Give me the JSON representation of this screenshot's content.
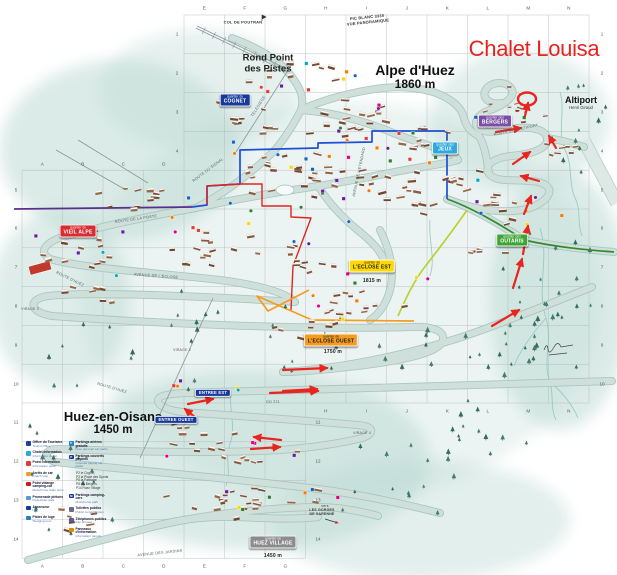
{
  "title": {
    "text": "Chalet Louisa",
    "x": 534,
    "y": 49,
    "color": "#e8231f"
  },
  "places": {
    "alpe": {
      "name": "Alpe d'Huez",
      "elev": "1860 m",
      "x": 415,
      "y": 77
    },
    "rond": {
      "line1": "Rond Point",
      "line2": "des Pistes",
      "x": 268,
      "y": 64
    },
    "huez": {
      "name": "Huez-en-Oisans",
      "elev": "1450 m",
      "x": 113,
      "y": 423
    },
    "altiport": {
      "name": "Altiport",
      "sub": "Henri Giraud",
      "x": 581,
      "y": 103
    }
  },
  "badges": [
    {
      "q": "quartier du",
      "name": "COGNET",
      "x": 235,
      "y": 100,
      "bg": "#16399a",
      "fg": "#fff"
    },
    {
      "q": "quartier des",
      "name": "JEUX",
      "x": 445,
      "y": 148,
      "bg": "#2fa9dd",
      "fg": "#fff"
    },
    {
      "q": "quartier des",
      "name": "BERGERS",
      "x": 495,
      "y": 121,
      "bg": "#7c4ea3",
      "fg": "#fff"
    },
    {
      "q": "quartier des",
      "name": "OUTARIS",
      "x": 512,
      "y": 240,
      "bg": "#3fa437",
      "fg": "#fff"
    },
    {
      "q": "quartier du",
      "name": "VIEIL ALPE",
      "x": 78,
      "y": 231,
      "bg": "#d92b32",
      "fg": "#fff"
    },
    {
      "q": "quartier de",
      "name": "L'ECLOSE EST",
      "x": 372,
      "y": 266,
      "bg": "#ffd800",
      "fg": "#222"
    },
    {
      "q": "quartier de",
      "name": "L'ECLOSE OUEST",
      "x": 331,
      "y": 340,
      "bg": "#f59b20",
      "fg": "#222"
    },
    {
      "q": "quartier de",
      "name": "HUEZ VILLAGE",
      "x": 273,
      "y": 542,
      "bg": "#8c8c8c",
      "fg": "#fff"
    },
    {
      "name": "ENTREE EST",
      "x": 213,
      "y": 393,
      "bg": "#16399a",
      "fg": "#fff"
    },
    {
      "name": "ENTREE OUEST",
      "x": 176,
      "y": 420,
      "bg": "#16399a",
      "fg": "#fff"
    }
  ],
  "small_labels": [
    {
      "t": "COL DE POUTRAN",
      "x": 243,
      "y": 22,
      "s": 4,
      "rot": 0,
      "c": "#333",
      "b": 1
    },
    {
      "t": "PIC BLANC 3330",
      "x": 367,
      "y": 17,
      "s": 4,
      "rot": -6,
      "c": "#333",
      "b": 1
    },
    {
      "t": "VUE PANORAMIQUE",
      "x": 368,
      "y": 22,
      "s": 4,
      "rot": -6,
      "c": "#333",
      "b": 1
    },
    {
      "t": "TELESIEGE",
      "x": 258,
      "y": 106,
      "s": 4,
      "rot": -58,
      "c": "#667",
      "b": 0
    },
    {
      "t": "ROUTE DU SIGNAL",
      "x": 208,
      "y": 170,
      "s": 3.8,
      "rot": -37,
      "c": "#4d6a66",
      "b": 0
    },
    {
      "t": "ROUTE DE LA POSTE",
      "x": 136,
      "y": 219,
      "s": 3.8,
      "rot": -8,
      "c": "#4d6a66",
      "b": 0
    },
    {
      "t": "AVENUE DE L'ETENDARD",
      "x": 359,
      "y": 172,
      "s": 3.8,
      "rot": -78,
      "c": "#4d6a66",
      "b": 0
    },
    {
      "t": "AVENUE DE L'ECLOSE",
      "x": 156,
      "y": 276,
      "s": 3.8,
      "rot": 4,
      "c": "#4d6a66",
      "b": 0
    },
    {
      "t": "ROUTE D'HUEZ",
      "x": 70,
      "y": 279,
      "s": 3.8,
      "rot": 26,
      "c": "#4d6a66",
      "b": 0
    },
    {
      "t": "ROUTE D'HUEZ",
      "x": 112,
      "y": 388,
      "s": 3.8,
      "rot": 16,
      "c": "#4d6a66",
      "b": 0
    },
    {
      "t": "ROUTE DE L'ALTIPORT",
      "x": 516,
      "y": 130,
      "s": 3.8,
      "rot": -12,
      "c": "#4d6a66",
      "b": 0
    },
    {
      "t": "AVENUE DES JARDINS",
      "x": 160,
      "y": 553,
      "s": 3.8,
      "rot": -6,
      "c": "#4d6a66",
      "b": 0
    },
    {
      "t": "RD 211",
      "x": 273,
      "y": 402,
      "s": 3.8,
      "rot": -2,
      "c": "#4d6a66",
      "b": 0
    },
    {
      "t": "VIRAGE 2",
      "x": 182,
      "y": 350,
      "s": 3.5,
      "rot": 0,
      "c": "#555",
      "b": 0
    },
    {
      "t": "VIRAGE 3",
      "x": 30,
      "y": 309,
      "s": 3.5,
      "rot": 0,
      "c": "#555",
      "b": 0
    },
    {
      "t": "VIRAGE 4",
      "x": 362,
      "y": 433,
      "s": 3.5,
      "rot": 0,
      "c": "#555",
      "b": 0
    },
    {
      "t": "vers",
      "x": 325,
      "y": 506,
      "s": 3.5,
      "rot": 0,
      "c": "#333",
      "b": 0
    },
    {
      "t": "LES GORGES",
      "x": 322,
      "y": 510,
      "s": 3.5,
      "rot": 0,
      "c": "#333",
      "b": 1
    },
    {
      "t": "DE SARENNE",
      "x": 322,
      "y": 514,
      "s": 3.5,
      "rot": 0,
      "c": "#333",
      "b": 1
    },
    {
      "t": "1815 m",
      "x": 372,
      "y": 281,
      "s": 5,
      "rot": 0,
      "c": "#222",
      "b": 1
    },
    {
      "t": "1750 m",
      "x": 333,
      "y": 352,
      "s": 5,
      "rot": 0,
      "c": "#222",
      "b": 1
    },
    {
      "t": "1450 m",
      "x": 273,
      "y": 556,
      "s": 5,
      "rot": 0,
      "c": "#222",
      "b": 1
    }
  ],
  "grid": {
    "dx": 40.5,
    "dy": 38.8,
    "top": [
      "E",
      "F",
      "G",
      "H",
      "I",
      "J",
      "K",
      "L",
      "M",
      "N"
    ],
    "top_y": 8,
    "top_x0": 204.3,
    "mid": [
      "A",
      "B",
      "C",
      "D"
    ],
    "mid_y": 164,
    "mid_x0": 42.3,
    "bottom": [
      "A",
      "B",
      "C",
      "D",
      "E",
      "F",
      "G"
    ],
    "bottom_y": 566,
    "bottom_x0": 42.3,
    "bottom_right": [
      "H",
      "I",
      "J",
      "K",
      "L",
      "M",
      "N"
    ],
    "br_y": 411,
    "br_x0": 325.8,
    "left_upper": [
      "1",
      "2",
      "3",
      "4"
    ],
    "lu_x": 177,
    "lu_y0": 34.4,
    "left_lower": [
      "5",
      "6",
      "7",
      "8",
      "9",
      "10",
      "11",
      "12",
      "13",
      "14"
    ],
    "ll_x": 16,
    "ll_y0": 189.6,
    "right_upper": [
      "1",
      "2",
      "3",
      "4",
      "5",
      "6",
      "7",
      "8",
      "9",
      "10"
    ],
    "ru_x": 602,
    "ru_y0": 34.4,
    "right_lower": [
      "11",
      "12",
      "13",
      "14"
    ],
    "rl_x": 318,
    "rl_y0": 422.4
  },
  "legend": {
    "x": 26,
    "y": 441,
    "left": [
      {
        "c": "#1e3f9e",
        "t": "Office du Tourisme",
        "s": "Tourist Office"
      },
      {
        "c": "#2fa9dd",
        "t": "Chalet information",
        "s": "Information chalet"
      },
      {
        "c": "#e03a3a",
        "t": "Point information",
        "s": "Information point"
      },
      {
        "c": "#f0a020",
        "t": "Arrêts de car",
        "s": "Coach stop"
      },
      {
        "c": "#d01818",
        "t": "Point vidange camping-car",
        "s": "Motorhome drain point"
      },
      {
        "c": "#5599dd",
        "t": "Promenade piétons",
        "s": "Pedestrian walk"
      },
      {
        "c": "#16399a",
        "t": "Ascenseur",
        "s": "Lift"
      },
      {
        "c": "#2a7fc0",
        "t": "Pistes de luge",
        "s": "Sledging runs"
      }
    ],
    "right": [
      {
        "c": "#2a7fc0",
        "p": "P",
        "t": "Parkings aériens gratuits",
        "s": "Free open-air car parks"
      },
      {
        "c": "#16399a",
        "p": "P",
        "t": "Parkings couverts payants",
        "s": "Covered paying car parks"
      },
      {
        "list": [
          "P2 le Cognet",
          "P3 la Place des Sports",
          "P5 la Patinoire",
          "P8 les Bergers",
          "P14 Huez Village"
        ]
      },
      {
        "c": "#16399a",
        "p": "M",
        "t": "Parkings camping-cars",
        "s": "Motorhome park"
      },
      {
        "c": "#6a6a8a",
        "t": "Toilettes publics",
        "s": "Public conveniences"
      },
      {
        "c": "#5a5a9a",
        "t": "Téléphones publics",
        "s": "Pay phones"
      },
      {
        "c": "#e08a00",
        "t": "Panneaux d'information",
        "s": "Information panels"
      }
    ]
  },
  "colors": {
    "wash": "#b9d8d1",
    "road_fill": "#cfe0da",
    "road_edge": "#a5c2bb",
    "grid": "#a9aeae",
    "red": "#e8251f",
    "stream": "#8fc6c0",
    "building_palette": [
      "#8a5a40",
      "#7a4c34",
      "#95684a",
      "#6e452f"
    ],
    "tree_palette": [
      "#2f6e5f",
      "#417e6d"
    ],
    "marker_palette": [
      "#e6007e",
      "#1565c0",
      "#ffd500",
      "#6a1b9a",
      "#00a7cf",
      "#e53935",
      "#f57c00",
      "#2e7d32"
    ]
  },
  "washes": [
    {
      "x": 120,
      "y": 150,
      "rx": 120,
      "ry": 90,
      "o": 0.5
    },
    {
      "x": 60,
      "y": 300,
      "rx": 70,
      "ry": 90,
      "o": 0.45
    },
    {
      "x": 340,
      "y": 300,
      "rx": 260,
      "ry": 200,
      "o": 0.28
    },
    {
      "x": 250,
      "y": 460,
      "rx": 180,
      "ry": 90,
      "o": 0.5
    },
    {
      "x": 560,
      "y": 300,
      "rx": 70,
      "ry": 130,
      "o": 0.5
    },
    {
      "x": 520,
      "y": 120,
      "rx": 90,
      "ry": 70,
      "o": 0.4
    },
    {
      "x": 200,
      "y": 90,
      "rx": 100,
      "ry": 60,
      "o": 0.35
    },
    {
      "x": 420,
      "y": 520,
      "rx": 150,
      "ry": 60,
      "o": 0.4
    }
  ],
  "roads": [
    "M 28,560 C 70,548 115,537 152,527 C 200,515 260,508 318,507 C 340,507 360,511 378,516",
    "M 152,527 C 175,520 205,516 235,517 C 265,518 292,520 318,517",
    "M 55,462 C 130,470 230,478 318,489 C 358,494 400,503 440,513",
    "M 55,462 C 43,458 43,449 58,449 C 125,451 205,454 280,450 C 320,447 346,442 362,438",
    "M 362,438 C 375,434 375,426 357,425 C 300,420 240,416 182,412",
    "M 612,381 C 500,385 350,389 212,392 C 186,393 164,393 159,398 C 155,404 165,410 182,412",
    "M 283,372 C 350,368 430,350 490,327 C 530,312 562,299 592,287",
    "M 295,302 C 220,297 90,291 48,296 C 28,299 28,312 52,316 C 150,323 300,330 413,327 C 438,326 449,334 440,345 C 428,357 380,364 330,369 C 308,371 292,372 283,372",
    "M 62,237 C 45,243 38,252 50,259 C 80,268 150,272 220,280 C 258,285 285,292 295,302",
    "M 62,237 C 120,222 160,214 196,208 C 240,198 280,192 318,186 C 352,181 392,172 422,167 C 442,164 452,162 458,160",
    "M 196,208 C 230,190 255,170 275,150 C 285,138 295,122 301,110",
    "M 301,110 C 306,95 296,82 288,72 C 276,58 252,45 232,38",
    "M 301,110 C 330,112 360,120 386,130 C 410,140 430,146 447,151 C 452,153 456,156 458,160",
    "M 301,110 C 322,100 352,92 382,88 C 402,86 422,88 436,93 C 452,99 462,108 464,118 C 466,127 472,133 479,136",
    "M 447,199 C 480,212 510,214 530,208 C 552,200 556,186 538,182 C 518,178 498,184 489,174 C 483,166 493,158 511,156 C 533,154 549,148 547,138 C 545,128 527,126 511,129 C 495,132 483,134 477,127 C 473,120 481,112 493,109",
    "M 479,136 C 485,146 487,160 489,174",
    "M 493,109 C 505,104 517,96 511,88 C 505,80 489,82 485,91 C 482,99 491,105 501,103",
    "M 547,138 C 560,140 572,143 584,147",
    "M 524,240 C 560,247 590,250 614,252",
    "M 447,199 C 470,207 500,224 524,240",
    "M 380,230 C 390,250 395,270 390,290 C 386,305 378,315 370,320",
    "M 318,186 C 330,205 345,220 360,232 C 372,242 380,250 384,260"
  ],
  "runway": {
    "d": "M 584,141 L 617,203",
    "w": 12
  },
  "streams": [
    "M 560,92 C 566,112 556,132 566,152 C 573,168 568,184 576,200 C 581,212 577,224 582,236",
    "M 540,228 C 550,258 536,288 546,318 C 553,343 542,360 550,382 C 554,396 550,408 556,420",
    "M 546,318 C 532,334 520,350 514,366",
    "M 550,382 C 562,392 572,404 578,418",
    "M 232,388 C 227,408 237,424 230,444 C 224,462 232,470 226,486",
    "M 430,220 C 428,240 436,258 430,276"
  ],
  "routes": [
    {
      "d": "M 14,209 L 192,207",
      "c": "#5b2d8e",
      "w": 1.8
    },
    {
      "d": "M 192,207 L 207,205 L 207,186 L 240,184 L 240,150 L 318,148 L 318,143 L 372,142 L 372,131 L 447,131 L 447,199",
      "c": "#1d4ed8",
      "w": 1.7
    },
    {
      "d": "M 207,204 L 207,186 L 240,184 L 262,184 L 262,206 L 291,206 L 291,217 L 311,218 L 293,266 L 291,310",
      "c": "#e0251f",
      "w": 1.4
    },
    {
      "d": "M 447,199 C 470,207 500,224 524,240 C 560,248 590,250 614,252",
      "c": "#2e8b2e",
      "w": 1.7
    },
    {
      "d": "M 467,210 C 452,232 438,250 424,268 C 414,281 406,298 398,316",
      "c": "#b8d22e",
      "w": 1.7
    },
    {
      "d": "M 414,321 L 312,320 L 257,296 L 268,311 L 309,290",
      "c": "#f59b20",
      "w": 1.7
    }
  ],
  "lifts": [
    {
      "x1": 197,
      "y1": 26,
      "x2": 289,
      "y2": 70,
      "ladder": true
    },
    {
      "x1": 292,
      "y1": 64,
      "x2": 236,
      "y2": 152
    },
    {
      "x1": 213,
      "y1": 298,
      "x2": 140,
      "y2": 458
    },
    {
      "x1": 56,
      "y1": 150,
      "x2": 126,
      "y2": 190
    },
    {
      "x1": 78,
      "y1": 140,
      "x2": 148,
      "y2": 183
    }
  ],
  "building_clusters": [
    {
      "x": 300,
      "y": 72,
      "w": 110,
      "h": 28,
      "n": 9
    },
    {
      "x": 252,
      "y": 118,
      "w": 80,
      "h": 40,
      "n": 10
    },
    {
      "x": 350,
      "y": 118,
      "w": 120,
      "h": 45,
      "n": 18
    },
    {
      "x": 425,
      "y": 140,
      "w": 80,
      "h": 45,
      "n": 12
    },
    {
      "x": 295,
      "y": 170,
      "w": 150,
      "h": 55,
      "n": 24
    },
    {
      "x": 390,
      "y": 195,
      "w": 120,
      "h": 55,
      "n": 18
    },
    {
      "x": 150,
      "y": 192,
      "w": 140,
      "h": 40,
      "n": 12
    },
    {
      "x": 88,
      "y": 245,
      "w": 130,
      "h": 55,
      "n": 12
    },
    {
      "x": 205,
      "y": 250,
      "w": 120,
      "h": 55,
      "n": 14
    },
    {
      "x": 300,
      "y": 258,
      "w": 90,
      "h": 45,
      "n": 10
    },
    {
      "x": 352,
      "y": 303,
      "w": 130,
      "h": 45,
      "n": 14
    },
    {
      "x": 462,
      "y": 182,
      "w": 55,
      "h": 55,
      "n": 8
    },
    {
      "x": 520,
      "y": 106,
      "w": 85,
      "h": 55,
      "n": 16,
      "s": 0.7
    },
    {
      "x": 560,
      "y": 152,
      "w": 55,
      "h": 35,
      "n": 7,
      "s": 0.8
    },
    {
      "x": 508,
      "y": 205,
      "w": 75,
      "h": 50,
      "n": 9
    },
    {
      "x": 240,
      "y": 452,
      "w": 150,
      "h": 45,
      "n": 16
    },
    {
      "x": 245,
      "y": 500,
      "w": 170,
      "h": 45,
      "n": 22
    },
    {
      "x": 178,
      "y": 428,
      "w": 60,
      "h": 28,
      "n": 6
    },
    {
      "x": 480,
      "y": 250,
      "w": 60,
      "h": 28,
      "n": 5
    },
    {
      "x": 95,
      "y": 292,
      "w": 90,
      "h": 28,
      "n": 7
    },
    {
      "x": 65,
      "y": 520,
      "w": 70,
      "h": 30,
      "n": 6
    },
    {
      "x": 300,
      "y": 330,
      "w": 90,
      "h": 30,
      "n": 7
    }
  ],
  "tree_zones": [
    {
      "x": 545,
      "y": 300,
      "w": 130,
      "h": 140,
      "n": 26
    },
    {
      "x": 480,
      "y": 355,
      "w": 120,
      "h": 60,
      "n": 14
    },
    {
      "x": 350,
      "y": 355,
      "w": 160,
      "h": 50,
      "n": 12
    },
    {
      "x": 120,
      "y": 355,
      "w": 160,
      "h": 70,
      "n": 12
    },
    {
      "x": 420,
      "y": 470,
      "w": 160,
      "h": 90,
      "n": 16
    },
    {
      "x": 80,
      "y": 505,
      "w": 110,
      "h": 70,
      "n": 10
    },
    {
      "x": 585,
      "y": 130,
      "w": 50,
      "h": 90,
      "n": 10
    },
    {
      "x": 230,
      "y": 310,
      "w": 120,
      "h": 40,
      "n": 8
    },
    {
      "x": 500,
      "y": 430,
      "w": 120,
      "h": 60,
      "n": 10
    },
    {
      "x": 60,
      "y": 440,
      "w": 60,
      "h": 40,
      "n": 6
    }
  ],
  "marker_zones": [
    {
      "x": 330,
      "y": 150,
      "w": 220,
      "h": 90,
      "n": 26
    },
    {
      "x": 260,
      "y": 220,
      "w": 180,
      "h": 70,
      "n": 14
    },
    {
      "x": 360,
      "y": 290,
      "w": 140,
      "h": 60,
      "n": 8
    },
    {
      "x": 300,
      "y": 75,
      "w": 120,
      "h": 40,
      "n": 8
    },
    {
      "x": 510,
      "y": 170,
      "w": 120,
      "h": 120,
      "n": 10
    },
    {
      "x": 250,
      "y": 470,
      "w": 180,
      "h": 80,
      "n": 12
    },
    {
      "x": 90,
      "y": 250,
      "w": 120,
      "h": 60,
      "n": 6
    },
    {
      "x": 210,
      "y": 395,
      "w": 80,
      "h": 40,
      "n": 5
    }
  ],
  "arrows": [
    {
      "x1": 496,
      "y1": 132,
      "x2": 521,
      "y2": 128
    },
    {
      "x1": 513,
      "y1": 164,
      "x2": 530,
      "y2": 152
    },
    {
      "x1": 539,
      "y1": 181,
      "x2": 521,
      "y2": 176
    },
    {
      "x1": 524,
      "y1": 214,
      "x2": 531,
      "y2": 196
    },
    {
      "x1": 523,
      "y1": 254,
      "x2": 528,
      "y2": 226
    },
    {
      "x1": 513,
      "y1": 288,
      "x2": 522,
      "y2": 259
    },
    {
      "x1": 492,
      "y1": 326,
      "x2": 519,
      "y2": 310
    },
    {
      "x1": 270,
      "y1": 393,
      "x2": 318,
      "y2": 391
    },
    {
      "x1": 196,
      "y1": 418,
      "x2": 185,
      "y2": 409
    },
    {
      "x1": 188,
      "y1": 404,
      "x2": 213,
      "y2": 399
    },
    {
      "x1": 281,
      "y1": 440,
      "x2": 254,
      "y2": 437
    },
    {
      "x1": 251,
      "y1": 449,
      "x2": 280,
      "y2": 447
    },
    {
      "x1": 283,
      "y1": 370,
      "x2": 327,
      "y2": 368
    },
    {
      "x1": 283,
      "y1": 391,
      "x2": 317,
      "y2": 389
    },
    {
      "x1": 525,
      "y1": 116,
      "x2": 528,
      "y2": 103
    },
    {
      "x1": 556,
      "y1": 148,
      "x2": 549,
      "y2": 136
    }
  ],
  "chalet_circle": {
    "x": 527,
    "y": 99,
    "rx": 9,
    "ry": 6.5
  },
  "extras": {
    "rink": {
      "x": 285,
      "y": 190,
      "rx": 9,
      "ry": 5
    },
    "red_building": {
      "x": 40,
      "y": 268,
      "w": 22,
      "h": 9,
      "rot": -15,
      "c": "#c0392b"
    },
    "signature": "M 544,350 q 3,-8 4,-1 q 1,7 6,-2 q 4,-7 7,0 l 12,-2 M 549,355 l 18,-2",
    "flag": "M 262,21 l 0,-6 l 4,2 l -4,2",
    "gorges_arrow": {
      "x1": 325,
      "y1": 519,
      "x2": 338,
      "y2": 523
    }
  }
}
